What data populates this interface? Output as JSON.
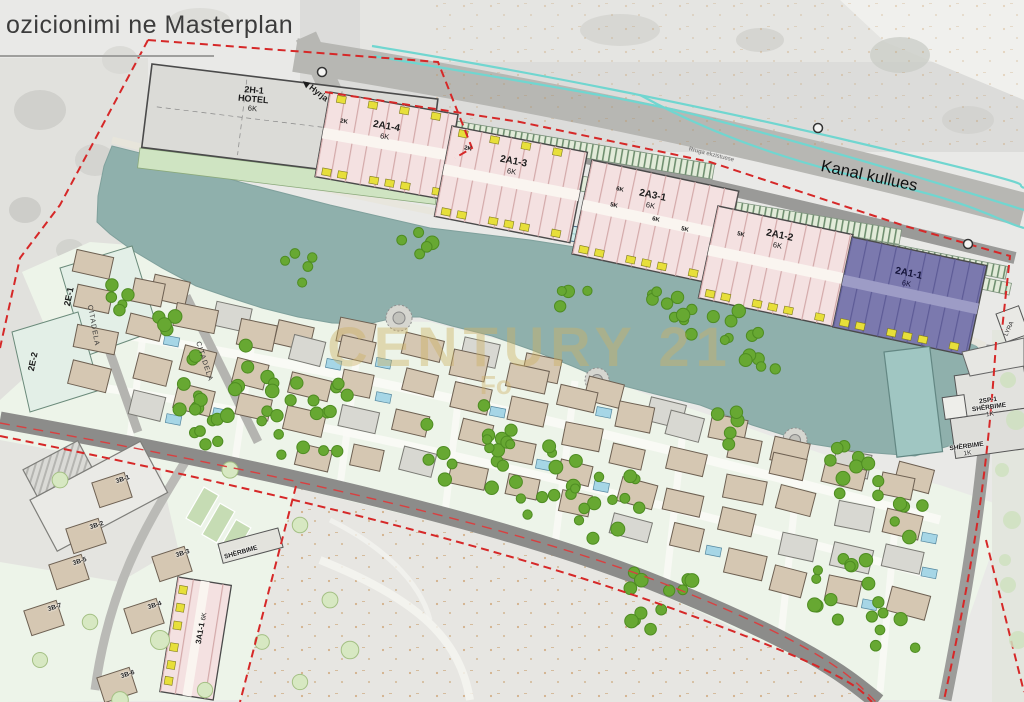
{
  "title": "ozicionimi ne Masterplan",
  "watermark": {
    "line1": "CENTURY 21",
    "line2": "Fo"
  },
  "map": {
    "canal_label": "Kanal kullues",
    "road_label": "Rruga ekzistuese",
    "entrance_label": "Hyrja",
    "entrance_arrow": "◀",
    "hotel": {
      "code": "2H-1",
      "name": "HOTEL",
      "floors": "6K"
    },
    "blocks": [
      {
        "code": "2A1-4",
        "floors": "6K",
        "end": "2K"
      },
      {
        "code": "2A1-3",
        "floors": "6K",
        "end": "2K"
      },
      {
        "code": "2A3-1",
        "floors": "6K",
        "subs": [
          "6K",
          "5K",
          "6K",
          "5K"
        ]
      },
      {
        "code": "2A1-2",
        "floors": "6K",
        "end": "5K"
      },
      {
        "code": "2A1-1",
        "floors": "6K"
      }
    ],
    "east_zones": [
      {
        "code": "2E-1"
      },
      {
        "code": "2E-2"
      }
    ],
    "street_name": "CITADELA",
    "services_1": {
      "code": "2SP-1",
      "name": "SHËRBIME",
      "floors": "1K"
    },
    "services_2": {
      "name": "SHËRBIME",
      "floors": "1K"
    },
    "lyra_label": "LYRA",
    "south": {
      "block": {
        "code": "3A1-1",
        "floors": "6K"
      },
      "services": "SHËRBIME",
      "villas": [
        "3B-1",
        "3B-2",
        "3B-3",
        "3B-4",
        "3B-5",
        "3B-6",
        "3B-7"
      ]
    }
  }
}
